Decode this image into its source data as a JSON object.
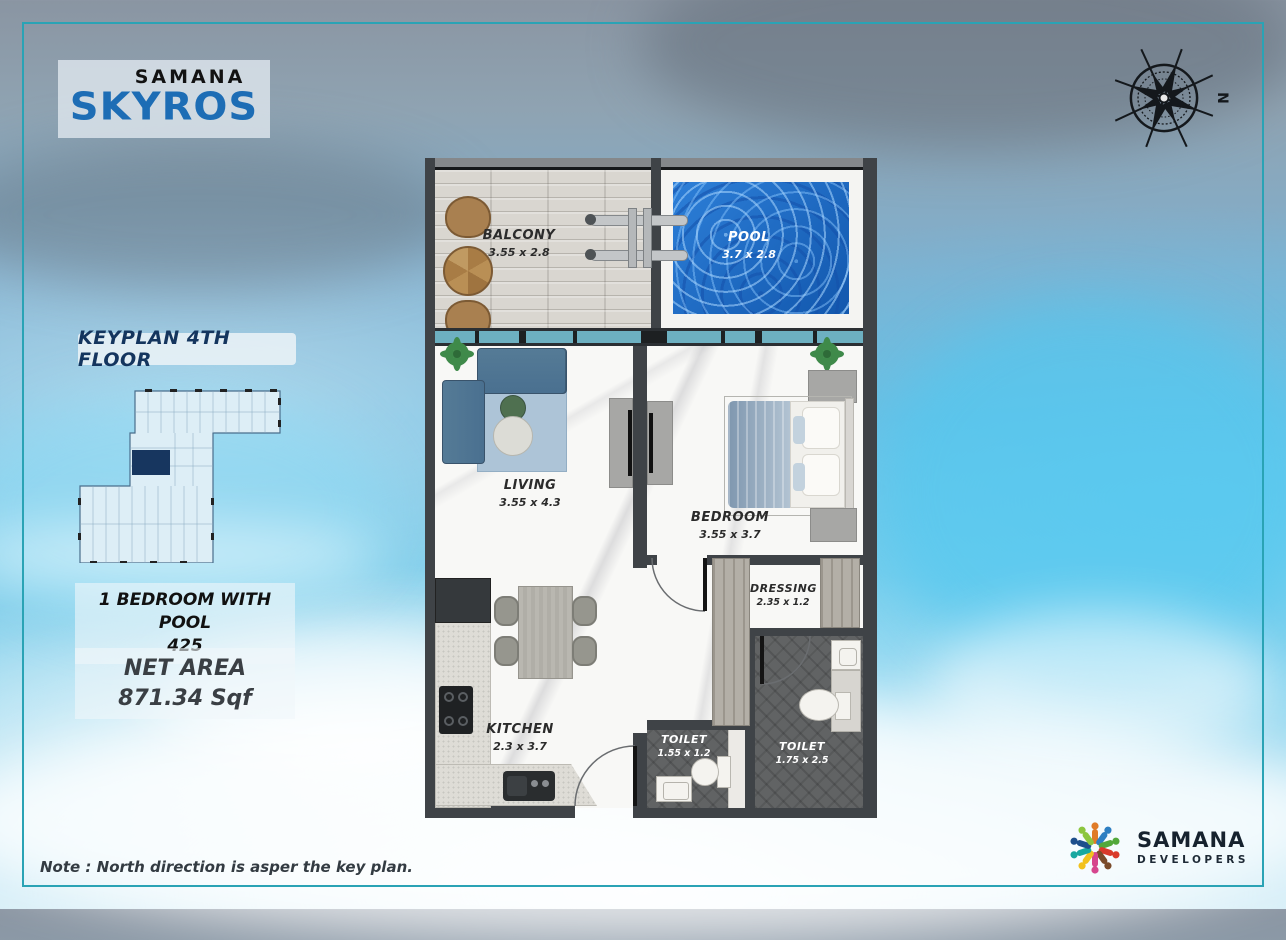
{
  "brand": {
    "top": "SAMANA",
    "name": "SKYROS"
  },
  "compass": {
    "label": "N"
  },
  "sidebar": {
    "keyplan_title": "KEYPLAN 4TH FLOOR",
    "unit_line1": "1 BEDROOM WITH POOL",
    "unit_line2": "425",
    "net_area_label": "NET AREA",
    "net_area_value": "871.34 Sqf"
  },
  "floorplan": {
    "balcony": {
      "name": "BALCONY",
      "dims": "3.55  x 2.8"
    },
    "pool": {
      "name": "POOL",
      "dims": "3.7 x 2.8"
    },
    "living": {
      "name": "LIVING",
      "dims": "3.55  x 4.3"
    },
    "bedroom": {
      "name": "BEDROOM",
      "dims": "3.55  x 3.7"
    },
    "kitchen": {
      "name": "KITCHEN",
      "dims": "2.3  x 3.7"
    },
    "dressing": {
      "name": "DRESSING",
      "dims": "2.35 x 1.2"
    },
    "toilet_small": {
      "name": "TOILET",
      "dims": "1.55 x 1.2"
    },
    "toilet_main": {
      "name": "TOILET",
      "dims": "1.75 x 2.5"
    }
  },
  "footer": {
    "note": "Note : North direction is asper the key plan.",
    "developer_name": "SAMANA",
    "developer_sub": "DEVELOPERS"
  },
  "colors": {
    "frame_teal": "#2aa3b5",
    "skyros_blue": "#1d6db5",
    "keyplan_navy": "#17365f",
    "pool_blue": "#1565c4",
    "wall_gray": "#3f4347"
  }
}
